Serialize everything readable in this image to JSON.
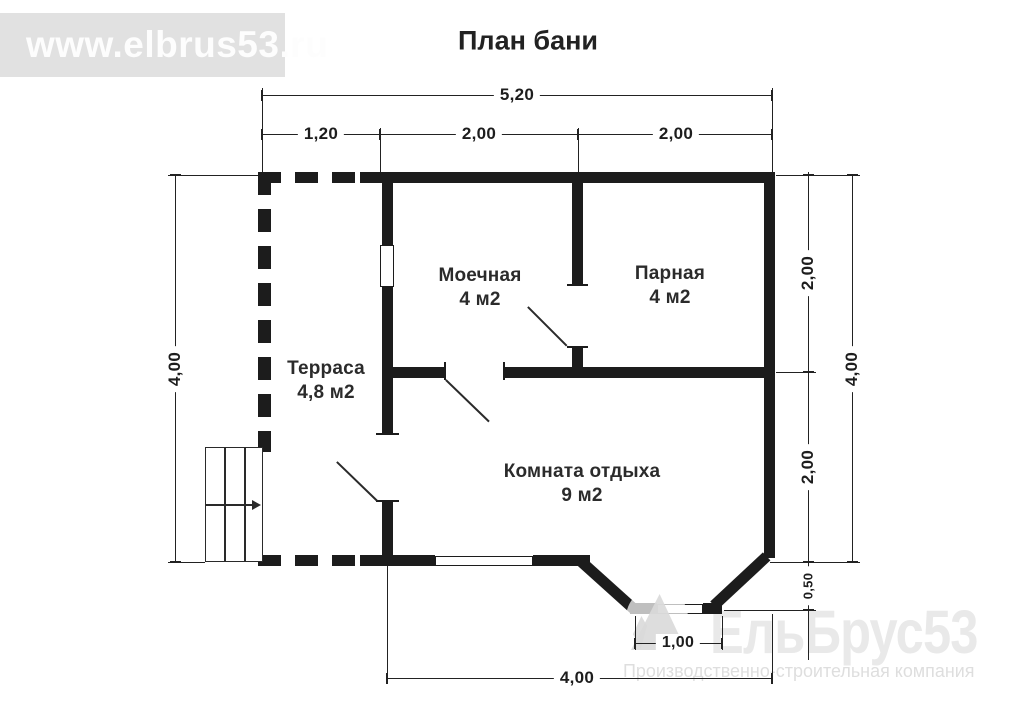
{
  "title": "План бани",
  "banner": {
    "url": "www.elbrus53.ru"
  },
  "rooms": [
    {
      "name": "Терраса",
      "area": "4,8 м2"
    },
    {
      "name": "Моечная",
      "area": "4 м2"
    },
    {
      "name": "Парная",
      "area": "4 м2"
    },
    {
      "name": "Комната отдыха",
      "area": "9 м2"
    }
  ],
  "dimensions": {
    "top_total": "5,20",
    "top_segments": [
      "1,20",
      "2,00",
      "2,00"
    ],
    "left_total": "4,00",
    "right_inner": [
      "2,00",
      "2,00",
      "0,50"
    ],
    "right_total": "4,00",
    "bottom_total": "4,00",
    "bay_width": "1,00"
  },
  "logo": {
    "name": "ЕльБрус53",
    "tagline": "Производственно-строительная компания"
  },
  "colors": {
    "wall": "#1c1c1c",
    "banner_bg": "#e1e1e1",
    "watermark_text": "#e9e9e9"
  }
}
